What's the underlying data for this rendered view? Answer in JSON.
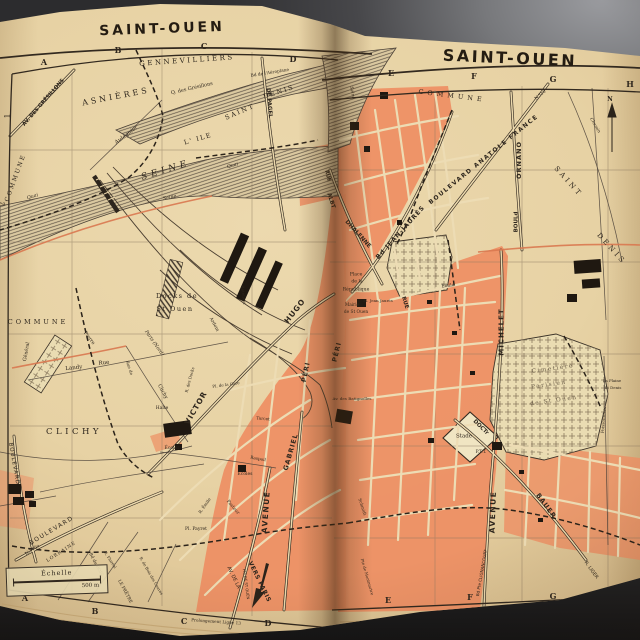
{
  "book": {
    "left_page": {
      "title": "SAINT-OUEN"
    },
    "right_page": {
      "title": "SAINT-OUEN"
    }
  },
  "map": {
    "colors": {
      "ink": "#2e261d",
      "paper": "#e7d3a7",
      "urban": "#ee8e63",
      "urban_light": "#f3b68b",
      "river_line": "#5f5446",
      "red_road": "#d97850",
      "cemetery": "#eadcb2",
      "bg_dark": "#3c3c3f",
      "bg_light": "#9a9b9f"
    },
    "scale": {
      "title": "Échelle",
      "distance": "500 m"
    },
    "annotations": {
      "north": "N",
      "vers_paris": "VERS PARIS"
    },
    "labels_left": [
      {
        "t": "A",
        "x": 44,
        "y": 62,
        "s": 8,
        "w": "b",
        "n": "grid-letter"
      },
      {
        "t": "B",
        "x": 118,
        "y": 50,
        "s": 8,
        "w": "b",
        "n": "grid-letter"
      },
      {
        "t": "C",
        "x": 204,
        "y": 46,
        "s": 8,
        "w": "b",
        "n": "grid-letter"
      },
      {
        "t": "D",
        "x": 293,
        "y": 59,
        "s": 8,
        "w": "b",
        "n": "grid-letter"
      },
      {
        "t": "A",
        "x": 25,
        "y": 598,
        "s": 8,
        "w": "b",
        "n": "grid-letter"
      },
      {
        "t": "B",
        "x": 95,
        "y": 611,
        "s": 8,
        "w": "b",
        "n": "grid-letter"
      },
      {
        "t": "C",
        "x": 184,
        "y": 621,
        "s": 8,
        "w": "b",
        "n": "grid-letter"
      },
      {
        "t": "D",
        "x": 268,
        "y": 623,
        "s": 8,
        "w": "b",
        "n": "grid-letter"
      },
      {
        "t": "1",
        "x": 8,
        "y": 116,
        "r": -90,
        "s": 7,
        "n": "grid-number"
      },
      {
        "t": "2",
        "x": 3,
        "y": 204,
        "r": -90,
        "s": 7,
        "n": "grid-number"
      },
      {
        "t": "GENNEVILLIERS",
        "x": 187,
        "y": 61,
        "r": -4,
        "s": 7,
        "ls": 2.5
      },
      {
        "t": "Q. des Grésillons",
        "x": 192,
        "y": 89,
        "r": -13,
        "s": 5
      },
      {
        "t": "ASNIÈRES",
        "x": 116,
        "y": 97,
        "r": -11,
        "s": 8,
        "ls": 3
      },
      {
        "t": "AV. DES GRÉSILLONS",
        "x": 44,
        "y": 103,
        "r": -49,
        "s": 5.2,
        "w": "b",
        "f": "sans"
      },
      {
        "t": "Aulagnier",
        "x": 127,
        "y": 136,
        "r": -37,
        "s": 5.5,
        "i": 1
      },
      {
        "t": "COMMUNE",
        "x": 16,
        "y": 178,
        "r": -70,
        "s": 6,
        "ls": 2
      },
      {
        "t": "L' ILE",
        "x": 198,
        "y": 139,
        "r": -16,
        "s": 6.5,
        "ls": 1.5
      },
      {
        "t": "SAINT",
        "x": 240,
        "y": 112,
        "r": -23,
        "s": 6.5,
        "ls": 2
      },
      {
        "t": "DENIS",
        "x": 279,
        "y": 92,
        "r": -18,
        "s": 6.5,
        "ls": 2
      },
      {
        "t": "Bd de l'Aéroplane",
        "x": 270,
        "y": 74,
        "r": -9,
        "s": 4.3
      },
      {
        "t": "DE PAGEL",
        "x": 268,
        "y": 103,
        "r": 85,
        "s": 5.5,
        "w": "b",
        "f": "sans"
      },
      {
        "t": "SEINE",
        "x": 166,
        "y": 171,
        "r": -17,
        "s": 9,
        "ls": 4,
        "i": 1
      },
      {
        "t": "Seine",
        "x": 170,
        "y": 199,
        "r": -12,
        "s": 4.8,
        "i": 1
      },
      {
        "t": "Quai",
        "x": 33,
        "y": 198,
        "r": -16,
        "s": 4.8,
        "i": 1
      },
      {
        "t": "Quai",
        "x": 233,
        "y": 167,
        "r": -15,
        "s": 4.8,
        "i": 1
      },
      {
        "t": "Docks de",
        "x": 177,
        "y": 296,
        "s": 6.5,
        "ls": 1.5
      },
      {
        "t": "St Ouen",
        "x": 175,
        "y": 309,
        "s": 6.5,
        "ls": 1.5
      },
      {
        "t": "Paris (Nord)",
        "x": 153,
        "y": 344,
        "r": 55,
        "s": 4.8,
        "i": 1
      },
      {
        "t": "COMMUNE",
        "x": 38,
        "y": 322,
        "s": 6.5,
        "ls": 3
      },
      {
        "t": "Pierre",
        "x": 88,
        "y": 339,
        "r": 53,
        "s": 4.8
      },
      {
        "t": "Général",
        "x": 28,
        "y": 352,
        "r": -80,
        "s": 4.8
      },
      {
        "t": "Landy",
        "x": 74,
        "y": 369,
        "r": -6,
        "s": 5.5
      },
      {
        "t": "Rue",
        "x": 104,
        "y": 364,
        "r": -6,
        "s": 5.5
      },
      {
        "t": "Rue de",
        "x": 129,
        "y": 368,
        "r": 72,
        "s": 4.2
      },
      {
        "t": "Clichy",
        "x": 162,
        "y": 392,
        "r": 62,
        "s": 5
      },
      {
        "t": "R. des Docks",
        "x": 190,
        "y": 380,
        "r": -75,
        "s": 4
      },
      {
        "t": "Ardoin",
        "x": 213,
        "y": 325,
        "r": 62,
        "s": 4.5
      },
      {
        "t": "Bateliers",
        "x": 243,
        "y": 295,
        "r": 83,
        "s": 4.2
      },
      {
        "t": "Halte",
        "x": 162,
        "y": 409,
        "s": 4.5
      },
      {
        "t": "Pl. de la Gare",
        "x": 226,
        "y": 385,
        "r": -8,
        "s": 4
      },
      {
        "t": "VICTOR",
        "x": 196,
        "y": 408,
        "r": -60,
        "s": 7.5,
        "w": "b",
        "f": "sans",
        "ls": 1
      },
      {
        "t": "HUGO",
        "x": 295,
        "y": 311,
        "r": -52,
        "s": 7.5,
        "w": "b",
        "f": "sans",
        "ls": 1
      },
      {
        "t": "GABRIEL",
        "x": 291,
        "y": 452,
        "r": -74,
        "s": 6.5,
        "w": "b",
        "f": "sans",
        "ls": 1
      },
      {
        "t": "PÉRI",
        "x": 306,
        "y": 372,
        "r": -78,
        "s": 6.5,
        "w": "b",
        "f": "sans",
        "ls": 1
      },
      {
        "t": "CLICHY",
        "x": 74,
        "y": 432,
        "s": 8.5,
        "ls": 3.5
      },
      {
        "t": "BOULEVARD",
        "x": 13,
        "y": 464,
        "r": 80,
        "s": 5.5,
        "ls": 1,
        "f": "sans"
      },
      {
        "t": "Écoles",
        "x": 172,
        "y": 449,
        "s": 4.5
      },
      {
        "t": "Écoles",
        "x": 245,
        "y": 475,
        "s": 4.5
      },
      {
        "t": "Raspail",
        "x": 258,
        "y": 459,
        "r": 10,
        "s": 4.2
      },
      {
        "t": "Tarcet",
        "x": 263,
        "y": 419,
        "r": 6,
        "s": 4.2
      },
      {
        "t": "Pasteur",
        "x": 232,
        "y": 508,
        "r": 50,
        "s": 4.5
      },
      {
        "t": "R. Émile",
        "x": 205,
        "y": 506,
        "r": -55,
        "s": 4.2
      },
      {
        "t": "Pl. Payret",
        "x": 196,
        "y": 530,
        "s": 4.5
      },
      {
        "t": "AVENUE",
        "x": 266,
        "y": 512,
        "r": -86,
        "s": 7.5,
        "w": "b",
        "f": "sans",
        "ls": 1.5
      },
      {
        "t": "AV. DE LA",
        "x": 233,
        "y": 578,
        "r": 64,
        "s": 5,
        "f": "sans"
      },
      {
        "t": "Pte DE ST OUEN",
        "x": 246,
        "y": 584,
        "r": 82,
        "s": 3.8,
        "f": "sans"
      },
      {
        "t": "VERS PARIS",
        "x": 259,
        "y": 582,
        "r": 64,
        "s": 6,
        "w": "b",
        "f": "sans",
        "ls": 0.5
      },
      {
        "t": "BOULEVARD",
        "x": 52,
        "y": 531,
        "r": -31,
        "s": 6,
        "ls": 1.5,
        "f": "sans"
      },
      {
        "t": "N.310a",
        "x": 33,
        "y": 551,
        "r": -33,
        "s": 4.5
      },
      {
        "t": "LORRAINE",
        "x": 62,
        "y": 553,
        "r": -33,
        "s": 4.6,
        "ls": 1
      },
      {
        "t": "Bd du BOIS",
        "x": 95,
        "y": 565,
        "r": 62,
        "s": 4.3
      },
      {
        "t": "LE PRÊTRE",
        "x": 124,
        "y": 592,
        "r": 62,
        "s": 4.3
      },
      {
        "t": "R. Floréal",
        "x": 110,
        "y": 560,
        "r": 57,
        "s": 3.9
      },
      {
        "t": "R. de Bois des Caures",
        "x": 151,
        "y": 576,
        "r": 60,
        "s": 3.9
      },
      {
        "t": "Prolongement Ligne 13",
        "x": 216,
        "y": 622,
        "r": 4,
        "s": 4.2
      }
    ],
    "labels_right": [
      {
        "t": "E",
        "x": 391,
        "y": 73,
        "s": 8,
        "w": "b",
        "n": "grid-letter"
      },
      {
        "t": "F",
        "x": 474,
        "y": 76,
        "s": 8,
        "w": "b",
        "n": "grid-letter"
      },
      {
        "t": "G",
        "x": 553,
        "y": 79,
        "s": 8,
        "w": "b",
        "n": "grid-letter"
      },
      {
        "t": "H",
        "x": 630,
        "y": 84,
        "s": 8,
        "w": "b",
        "n": "grid-letter"
      },
      {
        "t": "E",
        "x": 388,
        "y": 600,
        "s": 8,
        "w": "b",
        "n": "grid-letter"
      },
      {
        "t": "F",
        "x": 470,
        "y": 597,
        "s": 8,
        "w": "b",
        "n": "grid-letter"
      },
      {
        "t": "G",
        "x": 553,
        "y": 596,
        "s": 8,
        "w": "b",
        "n": "grid-letter"
      },
      {
        "t": "H",
        "x": 632,
        "y": 591,
        "s": 8,
        "w": "b",
        "n": "grid-letter"
      },
      {
        "t": "COMMUNE",
        "x": 452,
        "y": 96,
        "r": 7,
        "s": 6.5,
        "ls": 4
      },
      {
        "t": "Seine",
        "x": 351,
        "y": 93,
        "r": 80,
        "s": 4.5,
        "i": 1
      },
      {
        "t": "BOULEVARD ANATOLE FRANCE",
        "x": 484,
        "y": 160,
        "r": -39,
        "s": 6,
        "w": "b",
        "f": "sans",
        "ls": 1.5
      },
      {
        "t": "N.310",
        "x": 541,
        "y": 96,
        "r": -39,
        "s": 4.3
      },
      {
        "t": "ORNANO",
        "x": 519,
        "y": 160,
        "r": -90,
        "s": 6.5,
        "w": "b",
        "f": "sans",
        "ls": 1
      },
      {
        "t": "BOULd",
        "x": 517,
        "y": 222,
        "r": -90,
        "s": 5.5,
        "w": "b",
        "f": "sans"
      },
      {
        "t": "SAINT",
        "x": 568,
        "y": 182,
        "r": 48,
        "s": 7,
        "ls": 3
      },
      {
        "t": "DENIS",
        "x": 611,
        "y": 249,
        "r": 48,
        "s": 7,
        "ls": 3
      },
      {
        "t": "Chemin",
        "x": 594,
        "y": 126,
        "r": 60,
        "s": 4.3,
        "i": 1
      },
      {
        "t": "N",
        "x": 610,
        "y": 100,
        "s": 6,
        "w": "b",
        "n": "north-label"
      },
      {
        "t": "RUE",
        "x": 327,
        "y": 176,
        "r": 75,
        "s": 5,
        "w": "b",
        "f": "sans"
      },
      {
        "t": "ALBT",
        "x": 330,
        "y": 201,
        "r": 72,
        "s": 5.5,
        "w": "b",
        "f": "sans"
      },
      {
        "t": "DHALENNE",
        "x": 357,
        "y": 235,
        "r": 48,
        "s": 5.8,
        "w": "b",
        "f": "sans"
      },
      {
        "t": "Bd JEAN-JAURÈS",
        "x": 401,
        "y": 233,
        "r": -48,
        "s": 6.2,
        "w": "b",
        "f": "sans",
        "ls": 1
      },
      {
        "t": "Place",
        "x": 356,
        "y": 276,
        "s": 4.6
      },
      {
        "t": "de la",
        "x": 357,
        "y": 283,
        "s": 4.6
      },
      {
        "t": "République",
        "x": 356,
        "y": 291,
        "s": 4.6
      },
      {
        "t": "Mairie",
        "x": 352,
        "y": 306,
        "s": 4.3
      },
      {
        "t": "de St Ouen",
        "x": 356,
        "y": 313,
        "s": 4.3
      },
      {
        "t": "Pl. Jean Jaurès",
        "x": 378,
        "y": 301,
        "s": 4
      },
      {
        "t": "RUE",
        "x": 404,
        "y": 303,
        "r": 72,
        "s": 5.5,
        "w": "b",
        "f": "sans"
      },
      {
        "t": "Émile",
        "x": 448,
        "y": 287,
        "r": -6,
        "s": 4.4
      },
      {
        "t": "Cimetière",
        "x": 553,
        "y": 370,
        "r": -8,
        "s": 5.8,
        "ls": 1.5,
        "c": "#6d5f4a"
      },
      {
        "t": "Parisien",
        "x": 549,
        "y": 386,
        "r": -8,
        "s": 5.8,
        "ls": 1.5,
        "c": "#6d5f4a"
      },
      {
        "t": "de St Ouen",
        "x": 554,
        "y": 402,
        "r": -8,
        "s": 5.8,
        "ls": 1.5,
        "c": "#6d5f4a"
      },
      {
        "t": "La Plaine",
        "x": 612,
        "y": 381,
        "s": 3.9
      },
      {
        "t": "St Denis",
        "x": 613,
        "y": 388,
        "s": 3.9
      },
      {
        "t": "MICHELET",
        "x": 502,
        "y": 332,
        "r": -90,
        "s": 7,
        "w": "b",
        "f": "sans",
        "ls": 1
      },
      {
        "t": "AVENUE",
        "x": 493,
        "y": 512,
        "r": -88,
        "s": 7.5,
        "w": "b",
        "f": "sans",
        "ls": 1.5
      },
      {
        "t": "Stade",
        "x": 464,
        "y": 437,
        "s": 5.5
      },
      {
        "t": "DOCTr",
        "x": 480,
        "y": 428,
        "r": 44,
        "s": 5.5,
        "w": "b",
        "f": "sans"
      },
      {
        "t": "BAUER",
        "x": 546,
        "y": 506,
        "r": 54,
        "s": 6.5,
        "w": "b",
        "f": "sans",
        "ls": 1
      },
      {
        "t": "P.T.T.",
        "x": 481,
        "y": 453,
        "s": 4.4
      },
      {
        "t": "Av. des Batignolles",
        "x": 352,
        "y": 399,
        "s": 4.1
      },
      {
        "t": "PÉRI",
        "x": 337,
        "y": 352,
        "r": -76,
        "s": 6.5,
        "w": "b",
        "f": "sans",
        "ls": 1
      },
      {
        "t": "Schmidt",
        "x": 362,
        "y": 507,
        "r": 72,
        "s": 4.2
      },
      {
        "t": "Pte de Montmartre",
        "x": 367,
        "y": 577,
        "r": 74,
        "s": 3.9
      },
      {
        "t": "Bd Pte CLIGNANCOURT",
        "x": 482,
        "y": 573,
        "r": -80,
        "s": 4.1,
        "f": "sans"
      },
      {
        "t": "Poissonniers",
        "x": 604,
        "y": 420,
        "r": -85,
        "s": 4.2
      },
      {
        "t": "R. LIGER",
        "x": 590,
        "y": 571,
        "r": 54,
        "s": 4.8,
        "f": "sans"
      }
    ]
  }
}
